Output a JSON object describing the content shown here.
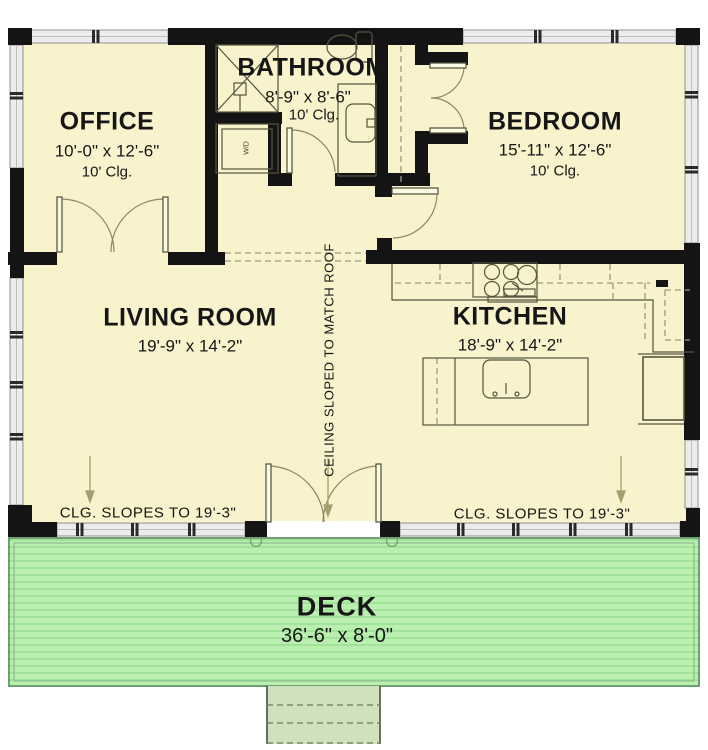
{
  "plan": {
    "rooms": {
      "office": {
        "name": "OFFICE",
        "dims": "10'-0\" x 12'-6\"",
        "ceiling": "10' Clg."
      },
      "bathroom": {
        "name": "BATHROOM",
        "dims": "8'-9\" x 8'-6\"",
        "ceiling": "10' Clg."
      },
      "bedroom": {
        "name": "BEDROOM",
        "dims": "15'-11\" x 12'-6\"",
        "ceiling": "10' Clg."
      },
      "living": {
        "name": "LIVING ROOM",
        "dims": "19'-9\" x 14'-2\""
      },
      "kitchen": {
        "name": "KITCHEN",
        "dims": "18'-9\" x 14'-2\""
      },
      "deck": {
        "name": "DECK",
        "dims": "36'-6\" x 8'-0\""
      }
    },
    "annotations": {
      "ceiling_sloped": "CEILING SLOPED TO MATCH ROOF",
      "clg_slope_left": "CLG. SLOPES TO 19'-3\"",
      "clg_slope_right": "CLG. SLOPES TO 19'-3\"",
      "washer_dryer": "W/D"
    },
    "colors": {
      "floor": "#f8f3cc",
      "wall": "#141414",
      "window_band": "#ececec",
      "deck": "#b9f0af",
      "deck_stripe": "#a3e29b",
      "deck_border": "#5d8c60",
      "steps": "#cfe0bc",
      "door_arc": "#8f8663",
      "dashed_line": "#9a9a80"
    }
  }
}
